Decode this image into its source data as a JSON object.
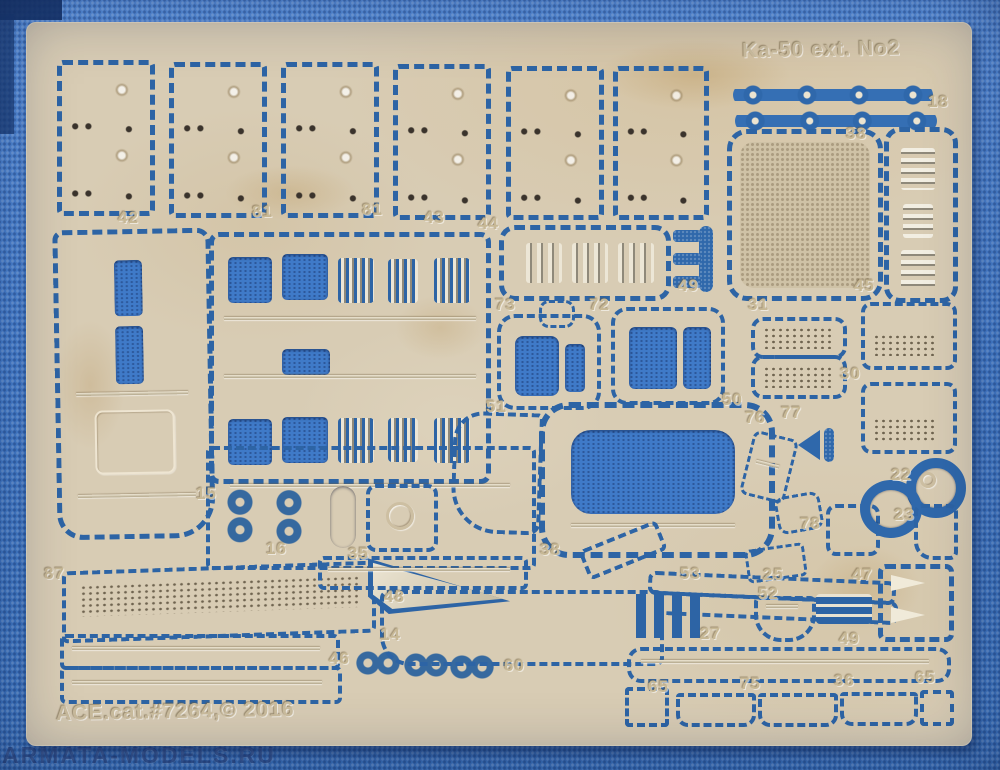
{
  "photo": {
    "title": "Ka-50 ext. No2",
    "catalog_text": "ACE.cat.#7264,© 2016",
    "watermark": "ARMATA-MODELS.RU",
    "colors": {
      "fabric_blue": "#4a86d8",
      "sheet_tan": "#d8ccb4",
      "etch_blue": "#2d64a5",
      "emboss_text": "#c7b895"
    },
    "part_labels": [
      {
        "t": "18",
        "x": 928,
        "y": 92
      },
      {
        "t": "42",
        "x": 118,
        "y": 208
      },
      {
        "t": "81",
        "x": 252,
        "y": 202
      },
      {
        "t": "81",
        "x": 362,
        "y": 200
      },
      {
        "t": "43",
        "x": 424,
        "y": 208
      },
      {
        "t": "44",
        "x": 478,
        "y": 214
      },
      {
        "t": "38",
        "x": 846,
        "y": 124
      },
      {
        "t": "45",
        "x": 854,
        "y": 276
      },
      {
        "t": "49",
        "x": 678,
        "y": 276
      },
      {
        "t": "73",
        "x": 495,
        "y": 295
      },
      {
        "t": "72",
        "x": 589,
        "y": 295
      },
      {
        "t": "31",
        "x": 748,
        "y": 295
      },
      {
        "t": "30",
        "x": 840,
        "y": 364
      },
      {
        "t": "50",
        "x": 722,
        "y": 390
      },
      {
        "t": "76",
        "x": 745,
        "y": 408
      },
      {
        "t": "77",
        "x": 781,
        "y": 403
      },
      {
        "t": "22",
        "x": 891,
        "y": 465
      },
      {
        "t": "23",
        "x": 894,
        "y": 505
      },
      {
        "t": "78",
        "x": 800,
        "y": 514
      },
      {
        "t": "15",
        "x": 196,
        "y": 484
      },
      {
        "t": "16",
        "x": 266,
        "y": 539
      },
      {
        "t": "35",
        "x": 348,
        "y": 544
      },
      {
        "t": "87",
        "x": 44,
        "y": 564
      },
      {
        "t": "51",
        "x": 486,
        "y": 397
      },
      {
        "t": "38",
        "x": 540,
        "y": 540
      },
      {
        "t": "53",
        "x": 680,
        "y": 564
      },
      {
        "t": "25",
        "x": 763,
        "y": 565
      },
      {
        "t": "52",
        "x": 758,
        "y": 584
      },
      {
        "t": "47",
        "x": 852,
        "y": 565
      },
      {
        "t": "48",
        "x": 384,
        "y": 587
      },
      {
        "t": "14",
        "x": 380,
        "y": 625
      },
      {
        "t": "46",
        "x": 329,
        "y": 649
      },
      {
        "t": "60",
        "x": 504,
        "y": 656
      },
      {
        "t": "27",
        "x": 700,
        "y": 624
      },
      {
        "t": "49",
        "x": 839,
        "y": 629
      },
      {
        "t": "65",
        "x": 648,
        "y": 677
      },
      {
        "t": "75",
        "x": 740,
        "y": 674
      },
      {
        "t": "36",
        "x": 834,
        "y": 671
      },
      {
        "t": "65",
        "x": 915,
        "y": 668
      }
    ]
  }
}
